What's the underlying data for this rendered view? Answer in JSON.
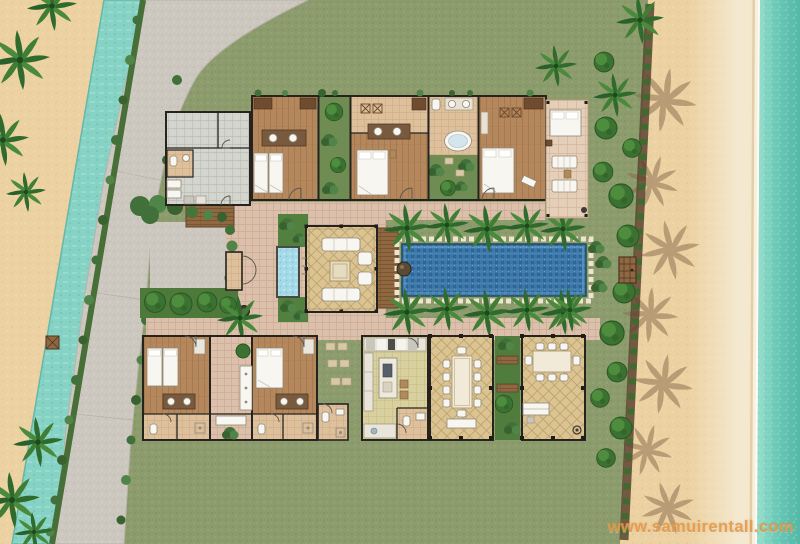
{
  "watermark": {
    "text": "www.samuirentall.com"
  },
  "palette": {
    "grass": "#8d9c6d",
    "road": "#ccc8c0",
    "sand": "#ecd2a2",
    "canal": "#86d2c4",
    "sea": "#6cc9b8",
    "walkway": "#dcc0ab",
    "terrace_tile": "#e5cfb8",
    "wood_floor": "#b5875c",
    "gray_tile": "#d3d5ce",
    "diamond_tile": "#dbc392",
    "kitchen_floor": "#d8d09e",
    "stone_floor": "#dec19c",
    "deck": "#8f6741",
    "pool": "#3a76a8",
    "pond": "#a4d9e7",
    "hedge": "#3f6b31",
    "palm": "#2f6b2c",
    "wall": "#26231f",
    "furniture": "#f8f6f0",
    "watermark": "#e29846"
  },
  "plan": {
    "type": "villa-site-floor-plan",
    "features": [
      "swimming-pool",
      "sun-deck",
      "lotus-pond",
      "living-pavilion",
      "dining-pavilion",
      "beach-sala",
      "kitchen",
      "guest-bedrooms",
      "master-bedroom",
      "open-air-bathroom",
      "service-quarters",
      "parking-court",
      "access-road",
      "canal",
      "palm-trees",
      "garden-hedges",
      "beach",
      "sea",
      "walkways",
      "beach-gate",
      "sun-loungers",
      "outdoor-daybed"
    ]
  }
}
